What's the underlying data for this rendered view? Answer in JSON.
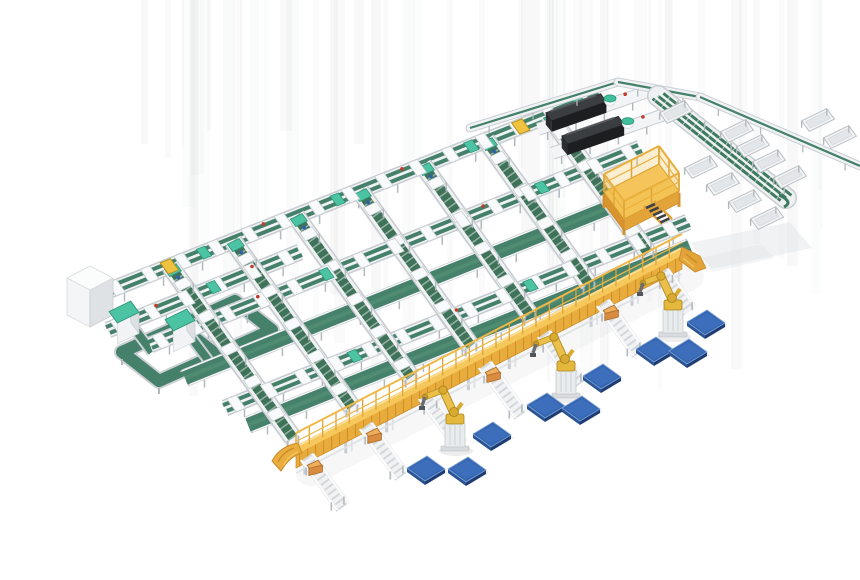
{
  "scene": {
    "type": "isometric-3d-render",
    "subject": "automated-parcel-sorting-and-palletizing-line",
    "width": 860,
    "height": 580,
    "background": "#ffffff"
  },
  "palette": {
    "belt_green": "#44806A",
    "belt_green_dark": "#3E7259",
    "belt_green_hi": "#538F74",
    "mint": "#4CC4A3",
    "mint_dark": "#2F9478",
    "frame_white": "#F0F2F3",
    "frame_edge": "#C6CBD0",
    "plate_white": "#F8FAFB",
    "leg_gray": "#B4B9BE",
    "gantry_yellow": "#F6C75B",
    "gantry_side": "#E8AC3C",
    "gantry_dark": "#C8892A",
    "robot_yellow": "#EAC04A",
    "robot_shadow": "#B9922A",
    "pallet_top": "#3566B0",
    "pallet_top_hi": "#4273C2",
    "pallet_side_dark": "#1D3C74",
    "pallet_side_light": "#2A5494",
    "machine_top": "#3B3E41",
    "machine_front": "#1C1E20",
    "tan_box": "#D98C3F",
    "tan_box_top": "#EFAE5C",
    "red_dot": "#C5392C",
    "blue_dot": "#2B5FB5",
    "streak_gray": "#8A9096",
    "shadow_gray": "#DFE2E5"
  },
  "background_streaks": {
    "count": 58,
    "x_min": 140,
    "x_max": 825,
    "seed": 7
  },
  "floor_shadows": [
    {
      "pts": [
        [
          690,
          243
        ],
        [
          790,
          222
        ],
        [
          812,
          248
        ],
        [
          712,
          269
        ]
      ],
      "opacity": 0.45
    },
    {
      "pts": [
        [
          700,
          258
        ],
        [
          762,
          244
        ],
        [
          774,
          258
        ],
        [
          712,
          272
        ]
      ],
      "opacity": 0.35
    }
  ],
  "loop_conveyor": {
    "outer": [
      [
        122,
        352
      ],
      [
        235,
        301
      ],
      [
        272,
        330
      ],
      [
        159,
        381
      ]
    ],
    "rung_t": 0.52,
    "feeds": [
      [
        [
          128,
          320
        ],
        [
          152,
          352
        ]
      ],
      [
        [
          184,
          328
        ],
        [
          208,
          360
        ]
      ]
    ]
  },
  "infeed_box": {
    "top_n": [
      90,
      266
    ],
    "top_e": [
      113,
      278
    ],
    "top_s": [
      90,
      290
    ],
    "top_w": [
      67,
      278
    ],
    "height": 37
  },
  "scanner_cabinets": [
    {
      "center": [
        124,
        312
      ],
      "half_a": 12,
      "half_b": 7,
      "height": 21
    },
    {
      "center": [
        180,
        320
      ],
      "half_a": 12,
      "half_b": 7,
      "height": 21
    }
  ],
  "transport_lines": [
    {
      "id": "header",
      "p0": [
        105,
        292
      ],
      "p1": [
        600,
        95
      ],
      "kind": "dual",
      "caps": [
        0.2,
        0.47,
        0.74,
        0.96
      ],
      "yellows": [
        0.13,
        0.84
      ],
      "reds": [
        0.32,
        0.6
      ]
    },
    {
      "id": "left-2",
      "p0": [
        108,
        330
      ],
      "p1": [
        300,
        252
      ],
      "kind": "dual",
      "caps": [
        0.55
      ],
      "yellows": [],
      "reds": [
        0.25,
        0.75
      ]
    },
    {
      "id": "cross-1",
      "p0": [
        150,
        345
      ],
      "p1": [
        640,
        148
      ],
      "kind": "dual",
      "caps": [
        0.36,
        0.8
      ],
      "yellows": [],
      "reds": [
        0.22,
        0.68
      ]
    },
    {
      "id": "cross-2",
      "p0": [
        185,
        378
      ],
      "p1": [
        665,
        185
      ],
      "kind": "belt",
      "caps": [],
      "yellows": [],
      "reds": []
    },
    {
      "id": "cross-3",
      "p0": [
        225,
        408
      ],
      "p1": [
        688,
        222
      ],
      "kind": "dual",
      "caps": [
        0.28,
        0.66
      ],
      "yellows": [],
      "reds": [
        0.5
      ]
    },
    {
      "id": "cross-4",
      "p0": [
        248,
        425
      ],
      "p1": [
        690,
        247
      ],
      "kind": "belt",
      "caps": [],
      "yellows": [],
      "reds": []
    }
  ],
  "sorter_spines": [
    {
      "p0": [
        170,
        266
      ],
      "p1": [
        293,
        438
      ]
    },
    {
      "p0": [
        233,
        241
      ],
      "p1": [
        352,
        407
      ]
    },
    {
      "p0": [
        296,
        216
      ],
      "p1": [
        411,
        377
      ]
    },
    {
      "p0": [
        360,
        191
      ],
      "p1": [
        471,
        346
      ]
    },
    {
      "p0": [
        423,
        165
      ],
      "p1": [
        530,
        315
      ]
    },
    {
      "p0": [
        486,
        140
      ],
      "p1": [
        589,
        284
      ]
    },
    {
      "p0": [
        549,
        115
      ],
      "p1": [
        648,
        253
      ]
    }
  ],
  "machines": [
    {
      "anchor": [
        542,
        128
      ],
      "u": [
        0.945,
        -0.327
      ],
      "bed_len": 112,
      "slab": [
        4,
        62
      ],
      "teal_t": 72,
      "red_t": 88
    },
    {
      "anchor": [
        556,
        152
      ],
      "u": [
        0.945,
        -0.327
      ],
      "bed_len": 116,
      "slab": [
        6,
        66
      ],
      "teal_t": 76,
      "red_t": 92
    }
  ],
  "top_line": {
    "pts": [
      [
        470,
        128
      ],
      [
        618,
        82
      ],
      [
        700,
        97
      ],
      [
        860,
        166
      ]
    ]
  },
  "right_sorter": {
    "p0": [
      658,
      96
    ],
    "p1": [
      786,
      198
    ],
    "lanes": 3
  },
  "output_trays": [
    {
      "c": [
        701,
        167
      ]
    },
    {
      "c": [
        723,
        184
      ]
    },
    {
      "c": [
        745,
        201
      ]
    },
    {
      "c": [
        767,
        218
      ]
    },
    {
      "c": [
        737,
        131
      ]
    },
    {
      "c": [
        753,
        146
      ]
    },
    {
      "c": [
        769,
        161
      ]
    },
    {
      "c": [
        790,
        177
      ]
    },
    {
      "c": [
        818,
        120
      ]
    },
    {
      "c": [
        840,
        137
      ]
    },
    {
      "c": [
        676,
        112
      ]
    }
  ],
  "operator_platform": {
    "deck": [
      [
        604,
        192
      ],
      [
        659,
        164
      ],
      [
        679,
        191
      ],
      [
        624,
        219
      ]
    ],
    "rail_h": 18,
    "stairs_from": [
      646,
      208
    ]
  },
  "gantry_walkway": {
    "p0": [
      296,
      450
    ],
    "p1": [
      682,
      251
    ],
    "side_h": 15,
    "rail_h": 17,
    "leg_every": 46
  },
  "pick_stub_conveyors": [
    {
      "p0": [
        307,
        457
      ],
      "p1": [
        343,
        507
      ]
    },
    {
      "p0": [
        366,
        426
      ],
      "p1": [
        402,
        476
      ]
    },
    {
      "p0": [
        425,
        396
      ],
      "p1": [
        461,
        446
      ]
    },
    {
      "p0": [
        485,
        365
      ],
      "p1": [
        521,
        415
      ]
    },
    {
      "p0": [
        544,
        334
      ],
      "p1": [
        580,
        384
      ]
    },
    {
      "p0": [
        603,
        303
      ],
      "p1": [
        639,
        353
      ]
    },
    {
      "p0": [
        662,
        272
      ],
      "p1": [
        690,
        311
      ]
    }
  ],
  "parcel_boxes": [
    [
      315,
      470
    ],
    [
      374,
      438
    ],
    [
      493,
      377
    ],
    [
      611,
      315
    ]
  ],
  "palletizing_robots": [
    {
      "base": [
        455,
        447
      ]
    },
    {
      "base": [
        566,
        394
      ]
    },
    {
      "base": [
        673,
        333
      ]
    }
  ],
  "pallets": [
    {
      "c": [
        426,
        468
      ]
    },
    {
      "c": [
        467,
        469
      ]
    },
    {
      "c": [
        492,
        434
      ]
    },
    {
      "c": [
        546,
        405
      ]
    },
    {
      "c": [
        581,
        408
      ]
    },
    {
      "c": [
        602,
        376
      ]
    },
    {
      "c": [
        655,
        349
      ]
    },
    {
      "c": [
        688,
        351
      ]
    },
    {
      "c": [
        706,
        322
      ]
    }
  ]
}
